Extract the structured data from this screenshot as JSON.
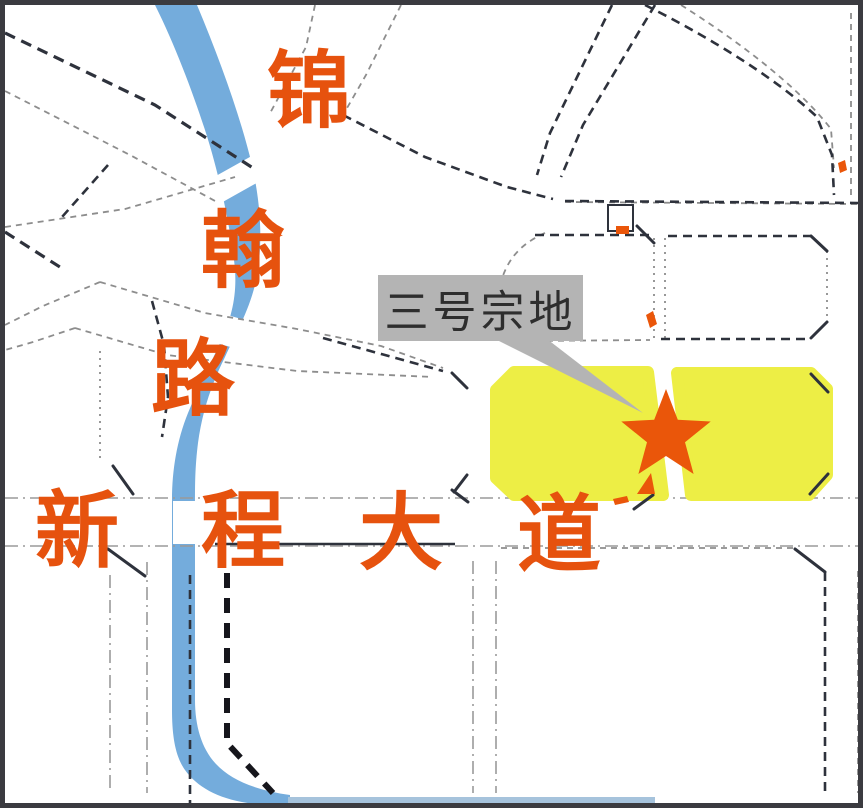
{
  "map": {
    "callout": {
      "label": "三号宗地"
    },
    "roads": {
      "jinhan": {
        "name": "锦翰路",
        "orientation": "vertical",
        "chars": [
          "锦",
          "翰",
          "路"
        ]
      },
      "xincheng": {
        "name": "新程大道",
        "orientation": "horizontal",
        "chars": [
          "新",
          "程",
          "大",
          "道"
        ]
      }
    },
    "site": {
      "marker": "star",
      "parcel_count": 2
    },
    "colors": {
      "road_label": "#E6520E",
      "star": "#EA560A",
      "river": "#74ACDC",
      "river_strip": "#A6C3DC",
      "parcel_yellow": "#EDEE45",
      "callout_bg": "#B4B4B4",
      "callout_text": "#2E2E2E",
      "frame": "#3B3B40"
    }
  }
}
